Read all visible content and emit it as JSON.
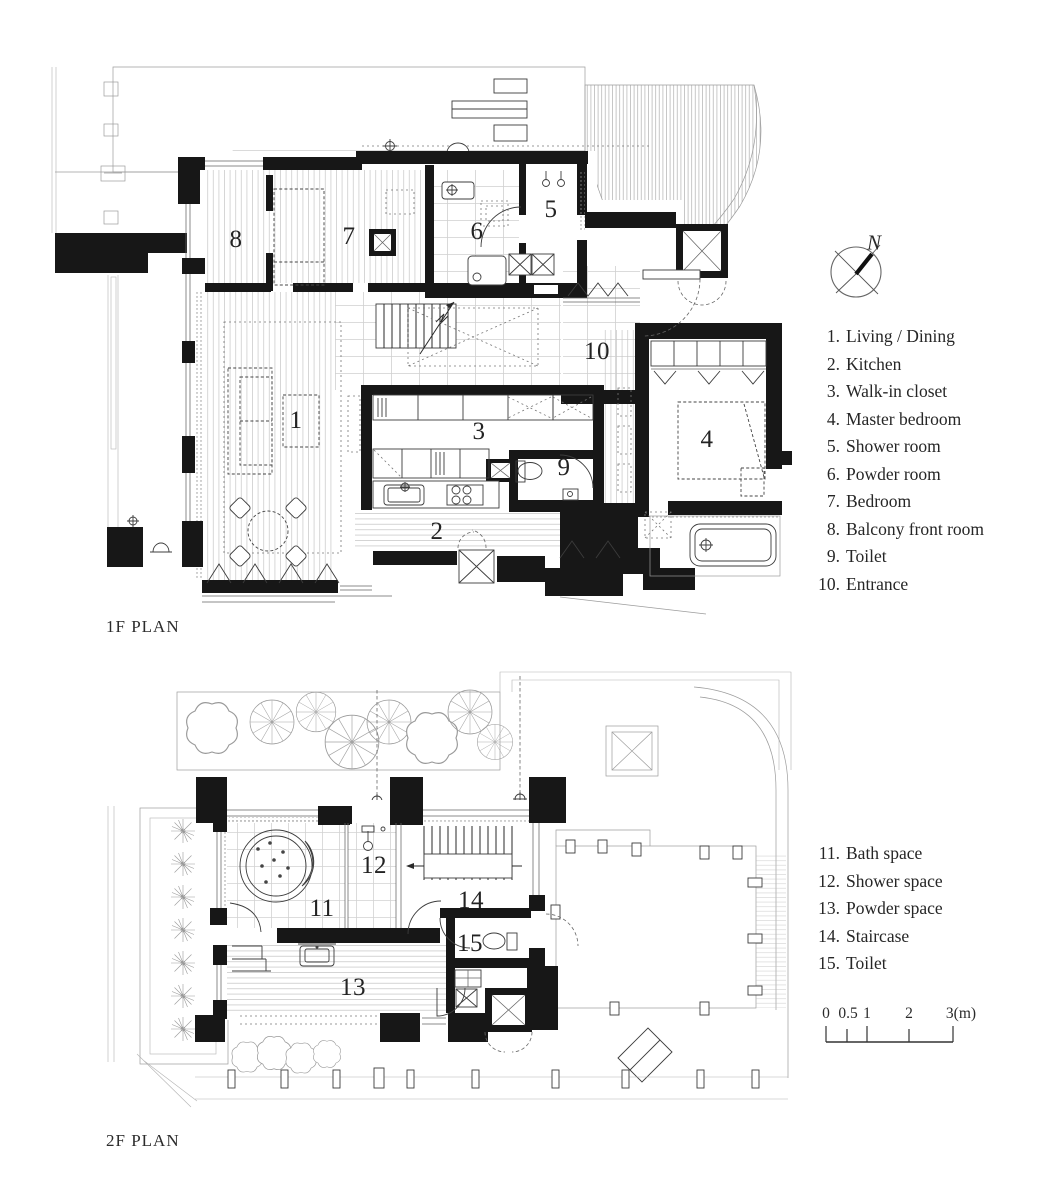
{
  "plan_1f": {
    "title": "1F PLAN",
    "rooms": [
      {
        "num": "1",
        "name": "Living / Dining"
      },
      {
        "num": "2",
        "name": "Kitchen"
      },
      {
        "num": "3",
        "name": "Walk-in closet"
      },
      {
        "num": "4",
        "name": "Master bedroom"
      },
      {
        "num": "5",
        "name": "Shower room"
      },
      {
        "num": "6",
        "name": "Powder room"
      },
      {
        "num": "7",
        "name": "Bedroom"
      },
      {
        "num": "8",
        "name": "Balcony front room"
      },
      {
        "num": "9",
        "name": "Toilet"
      },
      {
        "num": "10",
        "name": "Entrance"
      }
    ]
  },
  "plan_2f": {
    "title": "2F PLAN",
    "rooms": [
      {
        "num": "11",
        "name": "Bath space"
      },
      {
        "num": "12",
        "name": "Shower space"
      },
      {
        "num": "13",
        "name": "Powder space"
      },
      {
        "num": "14",
        "name": "Staircase"
      },
      {
        "num": "15",
        "name": "Toilet"
      }
    ]
  },
  "north": {
    "label": "N"
  },
  "scale": {
    "labels": [
      "0",
      "0.5",
      "1",
      "2",
      "3(m)"
    ]
  },
  "colors": {
    "ink": "#171717",
    "context_line": "#9c9c9c"
  }
}
